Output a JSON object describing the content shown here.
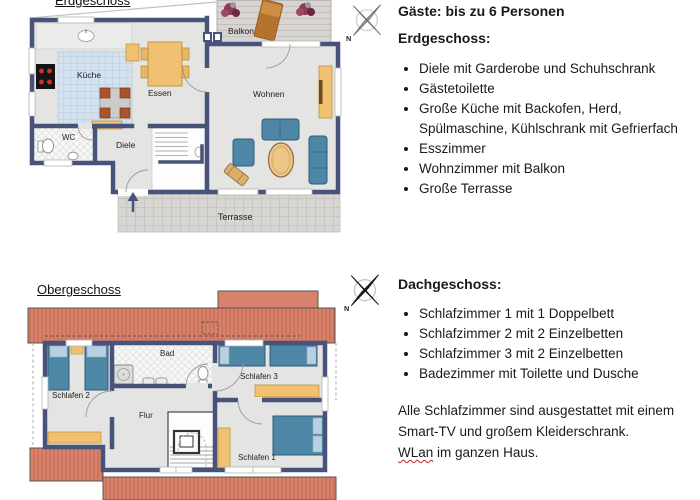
{
  "header": {
    "guests": "Gäste: bis zu 6 Personen"
  },
  "ground_floor": {
    "title": "Erdgeschoss",
    "heading": "Erdgeschoss:",
    "rooms": {
      "balkon": "Balkon",
      "kueche": "Küche",
      "essen": "Essen",
      "wohnen": "Wohnen",
      "wc": "WC",
      "diele": "Diele",
      "terrasse": "Terrasse"
    },
    "features": [
      "Diele mit Garderobe und Schuhschrank",
      "Gästetoilette",
      "Große Küche mit Backofen, Herd,\nSpülmaschine, Kühlschrank mit Gefrierfach",
      "Esszimmer",
      "Wohnzimmer mit Balkon",
      "Große Terrasse"
    ]
  },
  "upper_floor": {
    "title": "Obergeschoss",
    "heading": "Dachgeschoss:",
    "rooms": {
      "bad": "Bad",
      "flur": "Flur",
      "schlafen1": "Schlafen 1",
      "schlafen2": "Schlafen 2",
      "schlafen3": "Schlafen 3"
    },
    "features": [
      "Schlafzimmer 1 mit 1 Doppelbett",
      "Schlafzimmer 2 mit 2 Einzelbetten",
      "Schlafzimmer 3 mit 2 Einzelbetten",
      "Badezimmer mit Toilette und Dusche"
    ],
    "note": {
      "line1": "Alle Schlafzimmer sind ausgestattet mit einem",
      "line2": "Smart-TV und großem Kleiderschrank.",
      "wlan_word": "WLan",
      "line3_rest": " im ganzen Haus."
    }
  },
  "compass": {
    "north_label": "N"
  },
  "colors": {
    "wall_blue": "#47537b",
    "roof_salmon": "#d9826b",
    "furniture_blue": "#4e86a6",
    "furniture_tan": "#efc171",
    "kitchen_tile": "#d3e2ee",
    "squiggle_red": "#c52222"
  }
}
